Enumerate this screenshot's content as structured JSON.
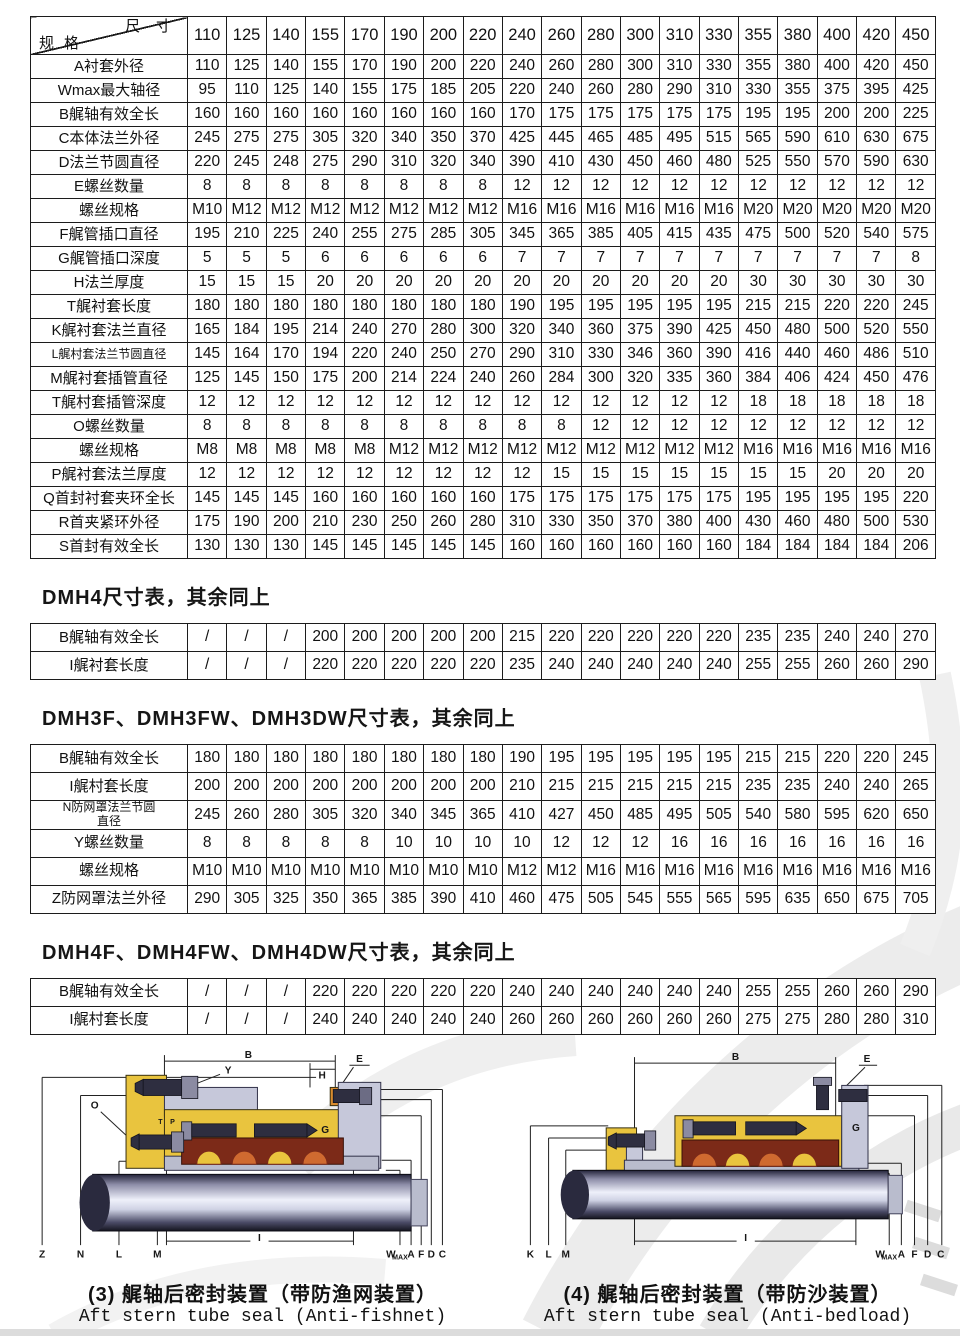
{
  "main_table": {
    "corner_top": "尺寸",
    "corner_bottom": "规格",
    "sizes": [
      "110",
      "125",
      "140",
      "155",
      "170",
      "190",
      "200",
      "220",
      "240",
      "260",
      "280",
      "300",
      "310",
      "330",
      "355",
      "380",
      "400",
      "420",
      "450"
    ],
    "rows": [
      {
        "label": "A衬套外径",
        "values": [
          "110",
          "125",
          "140",
          "155",
          "170",
          "190",
          "200",
          "220",
          "240",
          "260",
          "280",
          "300",
          "310",
          "330",
          "355",
          "380",
          "400",
          "420",
          "450"
        ]
      },
      {
        "label": "Wmax最大轴径",
        "values": [
          "95",
          "110",
          "125",
          "140",
          "155",
          "175",
          "185",
          "205",
          "220",
          "240",
          "260",
          "280",
          "290",
          "310",
          "330",
          "355",
          "375",
          "395",
          "425"
        ]
      },
      {
        "label": "B艉轴有效全长",
        "values": [
          "160",
          "160",
          "160",
          "160",
          "160",
          "160",
          "160",
          "160",
          "170",
          "175",
          "175",
          "175",
          "175",
          "175",
          "195",
          "195",
          "200",
          "200",
          "225"
        ]
      },
      {
        "label": "C本体法兰外径",
        "values": [
          "245",
          "275",
          "275",
          "305",
          "320",
          "340",
          "350",
          "370",
          "425",
          "445",
          "465",
          "485",
          "495",
          "515",
          "565",
          "590",
          "610",
          "630",
          "675"
        ]
      },
      {
        "label": "D法兰节圆直径",
        "values": [
          "220",
          "245",
          "248",
          "275",
          "290",
          "310",
          "320",
          "340",
          "390",
          "410",
          "430",
          "450",
          "460",
          "480",
          "525",
          "550",
          "570",
          "590",
          "630"
        ]
      },
      {
        "label": "E螺丝数量",
        "values": [
          "8",
          "8",
          "8",
          "8",
          "8",
          "8",
          "8",
          "8",
          "12",
          "12",
          "12",
          "12",
          "12",
          "12",
          "12",
          "12",
          "12",
          "12",
          "12"
        ]
      },
      {
        "label": "螺丝规格",
        "values": [
          "M10",
          "M12",
          "M12",
          "M12",
          "M12",
          "M12",
          "M12",
          "M12",
          "M16",
          "M16",
          "M16",
          "M16",
          "M16",
          "M16",
          "M20",
          "M20",
          "M20",
          "M20",
          "M20"
        ]
      },
      {
        "label": "F艉管插口直径",
        "values": [
          "195",
          "210",
          "225",
          "240",
          "255",
          "275",
          "285",
          "305",
          "345",
          "365",
          "385",
          "405",
          "415",
          "435",
          "475",
          "500",
          "520",
          "540",
          "575"
        ]
      },
      {
        "label": "G艉管插口深度",
        "values": [
          "5",
          "5",
          "5",
          "6",
          "6",
          "6",
          "6",
          "6",
          "7",
          "7",
          "7",
          "7",
          "7",
          "7",
          "7",
          "7",
          "7",
          "7",
          "8"
        ]
      },
      {
        "label": "H法兰厚度",
        "values": [
          "15",
          "15",
          "15",
          "20",
          "20",
          "20",
          "20",
          "20",
          "20",
          "20",
          "20",
          "20",
          "20",
          "20",
          "30",
          "30",
          "30",
          "30",
          "30"
        ]
      },
      {
        "label": "T艉衬套长度",
        "values": [
          "180",
          "180",
          "180",
          "180",
          "180",
          "180",
          "180",
          "180",
          "190",
          "195",
          "195",
          "195",
          "195",
          "195",
          "215",
          "215",
          "220",
          "220",
          "245"
        ]
      },
      {
        "label": "K艉衬套法兰直径",
        "values": [
          "165",
          "184",
          "195",
          "214",
          "240",
          "270",
          "280",
          "300",
          "320",
          "340",
          "360",
          "375",
          "390",
          "425",
          "450",
          "480",
          "500",
          "520",
          "550"
        ]
      },
      {
        "label": "L艉村套法兰节圆直径",
        "small": true,
        "values": [
          "145",
          "164",
          "170",
          "194",
          "220",
          "240",
          "250",
          "270",
          "290",
          "310",
          "330",
          "346",
          "360",
          "390",
          "416",
          "440",
          "460",
          "486",
          "510"
        ]
      },
      {
        "label": "M艉衬套插管直径",
        "values": [
          "125",
          "145",
          "150",
          "175",
          "200",
          "214",
          "224",
          "240",
          "260",
          "284",
          "300",
          "320",
          "335",
          "360",
          "384",
          "406",
          "424",
          "450",
          "476"
        ]
      },
      {
        "label": "T艉村套插管深度",
        "values": [
          "12",
          "12",
          "12",
          "12",
          "12",
          "12",
          "12",
          "12",
          "12",
          "12",
          "12",
          "12",
          "12",
          "12",
          "18",
          "18",
          "18",
          "18",
          "18"
        ]
      },
      {
        "label": "O螺丝数量",
        "values": [
          "8",
          "8",
          "8",
          "8",
          "8",
          "8",
          "8",
          "8",
          "8",
          "8",
          "12",
          "12",
          "12",
          "12",
          "12",
          "12",
          "12",
          "12",
          "12"
        ]
      },
      {
        "label": "螺丝规格",
        "values": [
          "M8",
          "M8",
          "M8",
          "M8",
          "M8",
          "M12",
          "M12",
          "M12",
          "M12",
          "M12",
          "M12",
          "M12",
          "M12",
          "M12",
          "M16",
          "M16",
          "M16",
          "M16",
          "M16"
        ]
      },
      {
        "label": "P艉衬套法兰厚度",
        "values": [
          "12",
          "12",
          "12",
          "12",
          "12",
          "12",
          "12",
          "12",
          "12",
          "15",
          "15",
          "15",
          "15",
          "15",
          "15",
          "15",
          "20",
          "20",
          "20"
        ]
      },
      {
        "label": "Q首封衬套夹环全长",
        "values": [
          "145",
          "145",
          "145",
          "160",
          "160",
          "160",
          "160",
          "160",
          "175",
          "175",
          "175",
          "175",
          "175",
          "175",
          "195",
          "195",
          "195",
          "195",
          "220"
        ]
      },
      {
        "label": "R首夹紧环外径",
        "values": [
          "175",
          "190",
          "200",
          "210",
          "230",
          "250",
          "260",
          "280",
          "310",
          "330",
          "350",
          "370",
          "380",
          "400",
          "430",
          "460",
          "480",
          "500",
          "530"
        ]
      },
      {
        "label": "S首封有效全长",
        "values": [
          "130",
          "130",
          "130",
          "145",
          "145",
          "145",
          "145",
          "145",
          "160",
          "160",
          "160",
          "160",
          "160",
          "160",
          "184",
          "184",
          "184",
          "184",
          "206"
        ]
      }
    ]
  },
  "sections": {
    "dmh4": {
      "title": "DMH4尺寸表，其余同上",
      "rows": [
        {
          "label": "B艉轴有效全长",
          "values": [
            "/",
            "/",
            "/",
            "200",
            "200",
            "200",
            "200",
            "200",
            "215",
            "220",
            "220",
            "220",
            "220",
            "220",
            "235",
            "235",
            "240",
            "240",
            "270"
          ]
        },
        {
          "label": "I艉衬套长度",
          "values": [
            "/",
            "/",
            "/",
            "220",
            "220",
            "220",
            "220",
            "220",
            "235",
            "240",
            "240",
            "240",
            "240",
            "240",
            "255",
            "255",
            "260",
            "260",
            "290"
          ]
        }
      ]
    },
    "dmh3f": {
      "title": "DMH3F、DMH3FW、DMH3DW尺寸表，其余同上",
      "rows": [
        {
          "label": "B艉轴有效全长",
          "values": [
            "180",
            "180",
            "180",
            "180",
            "180",
            "180",
            "180",
            "180",
            "190",
            "195",
            "195",
            "195",
            "195",
            "195",
            "215",
            "215",
            "220",
            "220",
            "245"
          ]
        },
        {
          "label": "I艉村套长度",
          "values": [
            "200",
            "200",
            "200",
            "200",
            "200",
            "200",
            "200",
            "200",
            "210",
            "215",
            "215",
            "215",
            "215",
            "215",
            "235",
            "235",
            "240",
            "240",
            "265"
          ]
        },
        {
          "label": "N防网罩法兰节圆\n直径",
          "small": true,
          "values": [
            "245",
            "260",
            "280",
            "305",
            "320",
            "340",
            "345",
            "365",
            "410",
            "427",
            "450",
            "485",
            "495",
            "505",
            "540",
            "580",
            "595",
            "620",
            "650"
          ]
        },
        {
          "label": "Y螺丝数量",
          "values": [
            "8",
            "8",
            "8",
            "8",
            "8",
            "10",
            "10",
            "10",
            "10",
            "12",
            "12",
            "12",
            "16",
            "16",
            "16",
            "16",
            "16",
            "16",
            "16"
          ]
        },
        {
          "label": "螺丝规格",
          "values": [
            "M10",
            "M10",
            "M10",
            "M10",
            "M10",
            "M10",
            "M10",
            "M10",
            "M12",
            "M12",
            "M16",
            "M16",
            "M16",
            "M16",
            "M16",
            "M16",
            "M16",
            "M16",
            "M16"
          ]
        },
        {
          "label": "Z防网罩法兰外径",
          "values": [
            "290",
            "305",
            "325",
            "350",
            "365",
            "385",
            "390",
            "410",
            "460",
            "475",
            "505",
            "545",
            "555",
            "565",
            "595",
            "635",
            "650",
            "675",
            "705"
          ]
        }
      ]
    },
    "dmh4f": {
      "title": "DMH4F、DMH4FW、DMH4DW尺寸表，其余同上",
      "rows": [
        {
          "label": "B艉轴有效全长",
          "values": [
            "/",
            "/",
            "/",
            "220",
            "220",
            "220",
            "220",
            "220",
            "240",
            "240",
            "240",
            "240",
            "240",
            "240",
            "255",
            "255",
            "260",
            "260",
            "290"
          ]
        },
        {
          "label": "I艉村套长度",
          "values": [
            "/",
            "/",
            "/",
            "240",
            "240",
            "240",
            "240",
            "240",
            "260",
            "260",
            "260",
            "260",
            "260",
            "260",
            "275",
            "275",
            "280",
            "280",
            "310"
          ]
        }
      ]
    }
  },
  "diagrams": [
    {
      "caption_zh": "(3) 艉轴后密封装置（带防渔网装置）",
      "caption_en": "Aft stern tube seal (Anti-fishnet)",
      "labels": {
        "b": "B",
        "y": "Y",
        "h": "H",
        "e": "E",
        "o": "O",
        "t": "T",
        "p": "P",
        "g": "G",
        "z": "Z",
        "n": "N",
        "l": "L",
        "m": "M",
        "i": "I",
        "w": "W",
        "wsub": "MAX",
        "a": "A",
        "f": "F",
        "d": "D",
        "c": "C"
      }
    },
    {
      "caption_zh": "(4) 艉轴后密封装置（带防沙装置）",
      "caption_en": "Aft stern tube seal (Anti-bedload)",
      "labels": {
        "b": "B",
        "e": "E",
        "g": "G",
        "k": "K",
        "l": "L",
        "m": "M",
        "i": "I",
        "w": "W",
        "wsub": "MAX",
        "a": "A",
        "f": "F",
        "d": "D",
        "c": "C"
      }
    }
  ],
  "colors": {
    "table_border": "#1c1c1c",
    "housing_yellow": "#e9c43e",
    "steel_gray": "#c6c8da",
    "seal_red": "#7c2a18",
    "seal_orange": "#cf6a30",
    "watermark_gray": "#ececec"
  }
}
